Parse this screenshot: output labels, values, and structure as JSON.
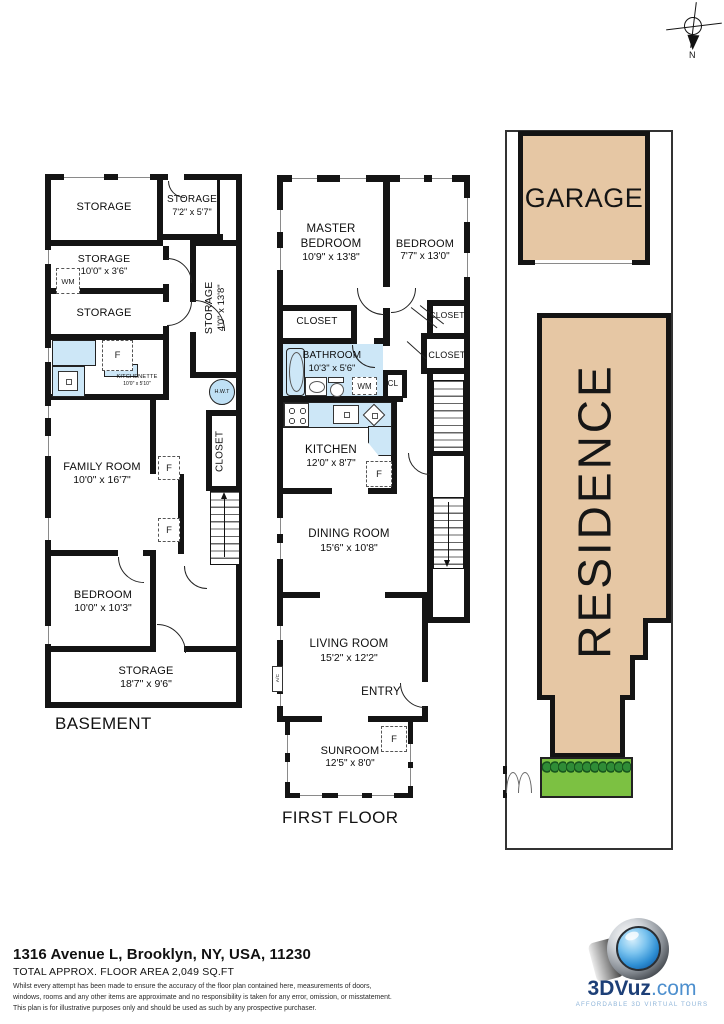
{
  "compass": {
    "north": "N"
  },
  "labels": {
    "f": "F",
    "wm": "WM",
    "cl": "CL",
    "ac": "A/C",
    "hwt": "H.W.T",
    "closet": "CLOSET"
  },
  "basement": {
    "title": "BASEMENT",
    "storage_top": {
      "name": "STORAGE"
    },
    "storage_7_2": {
      "name": "STORAGE",
      "dims": "7'2\" x 5'7\""
    },
    "storage_10_0": {
      "name": "STORAGE",
      "dims": "10'0\" x 3'6\""
    },
    "storage_4_0": {
      "name": "STORAGE",
      "dims": "4'0\" x 13'8\""
    },
    "storage_mid": {
      "name": "STORAGE"
    },
    "kitchenette": {
      "name": "KITCHENETTE",
      "dims": "10'0\" x 5'10\""
    },
    "family_room": {
      "name": "FAMILY ROOM",
      "dims": "10'0\" x 16'7\""
    },
    "bedroom": {
      "name": "BEDROOM",
      "dims": "10'0\" x 10'3\""
    },
    "storage_18_7": {
      "name": "STORAGE",
      "dims": "18'7\" x 9'6\""
    }
  },
  "first_floor": {
    "title": "FIRST FLOOR",
    "master_bedroom": {
      "name": "MASTER BEDROOM",
      "dims": "10'9\" x 13'8\""
    },
    "bedroom": {
      "name": "BEDROOM",
      "dims": "7'7\" x 13'0\""
    },
    "bathroom": {
      "name": "BATHROOM",
      "dims": "10'3\" x 5'6\""
    },
    "kitchen": {
      "name": "KITCHEN",
      "dims": "12'0\" x 8'7\""
    },
    "dining_room": {
      "name": "DINING ROOM",
      "dims": "15'6\" x 10'8\""
    },
    "living_room": {
      "name": "LIVING ROOM",
      "dims": "15'2\" x 12'2\""
    },
    "entry": {
      "name": "ENTRY"
    },
    "sunroom": {
      "name": "SUNROOM",
      "dims": "12'5\" x 8'0\""
    }
  },
  "site": {
    "garage": "GARAGE",
    "residence": "RESIDENCE"
  },
  "footer": {
    "address": "1316 Avenue L, Brooklyn, NY, USA, 11230",
    "area": "TOTAL APPROX. FLOOR AREA 2,049 SQ.FT",
    "disclaimer1": "Whilst every attempt has been made to ensure the accuracy of the floor plan contained here, measurements of doors,",
    "disclaimer2": "windows, rooms and any other items are approximate and no responsibility is taken for any error, omission, or misstatement.",
    "disclaimer3": "This plan is for illustrative purposes only and should be used as such by any prospective purchaser."
  },
  "logo": {
    "brand": "3DVuz",
    "suffix": ".com",
    "tagline": "AFFORDABLE 3D VIRTUAL TOURS"
  },
  "colors": {
    "wall": "#141414",
    "fixture_blue": "#cde7f7",
    "site_tan": "#e6c7a4",
    "lawn_green": "#7cc142",
    "hedge_green": "#17551d",
    "logo_blue": "#1d3f77",
    "logo_light_blue": "#4d8fce"
  }
}
